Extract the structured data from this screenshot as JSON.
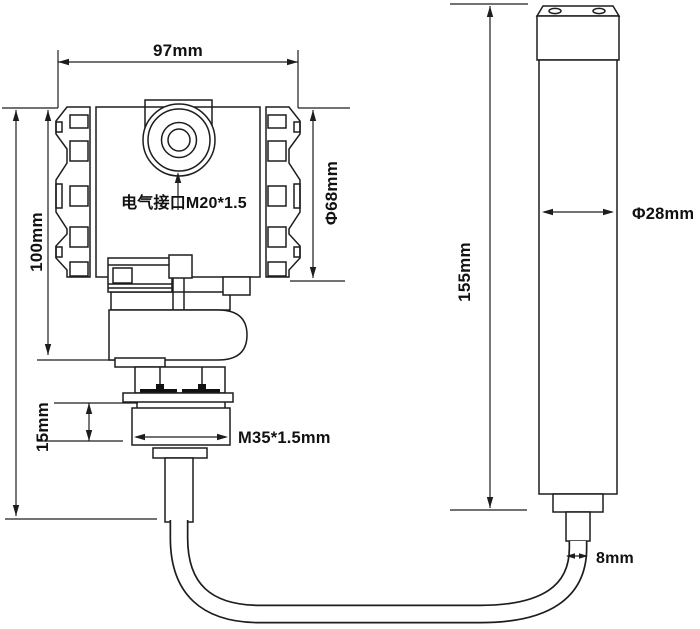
{
  "drawing": {
    "background": "#ffffff",
    "line_color": "#1d1d1b",
    "annotations": {
      "housing_width": "97mm",
      "housing_height": "100mm",
      "housing_diameter": "Φ68mm",
      "electrical_interface": "电气接口M20*1.5",
      "nut_height": "15mm",
      "thread_spec": "M35*1.5mm",
      "probe_length": "155mm",
      "probe_diameter": "Φ28mm",
      "cable_diameter": "8mm"
    }
  }
}
